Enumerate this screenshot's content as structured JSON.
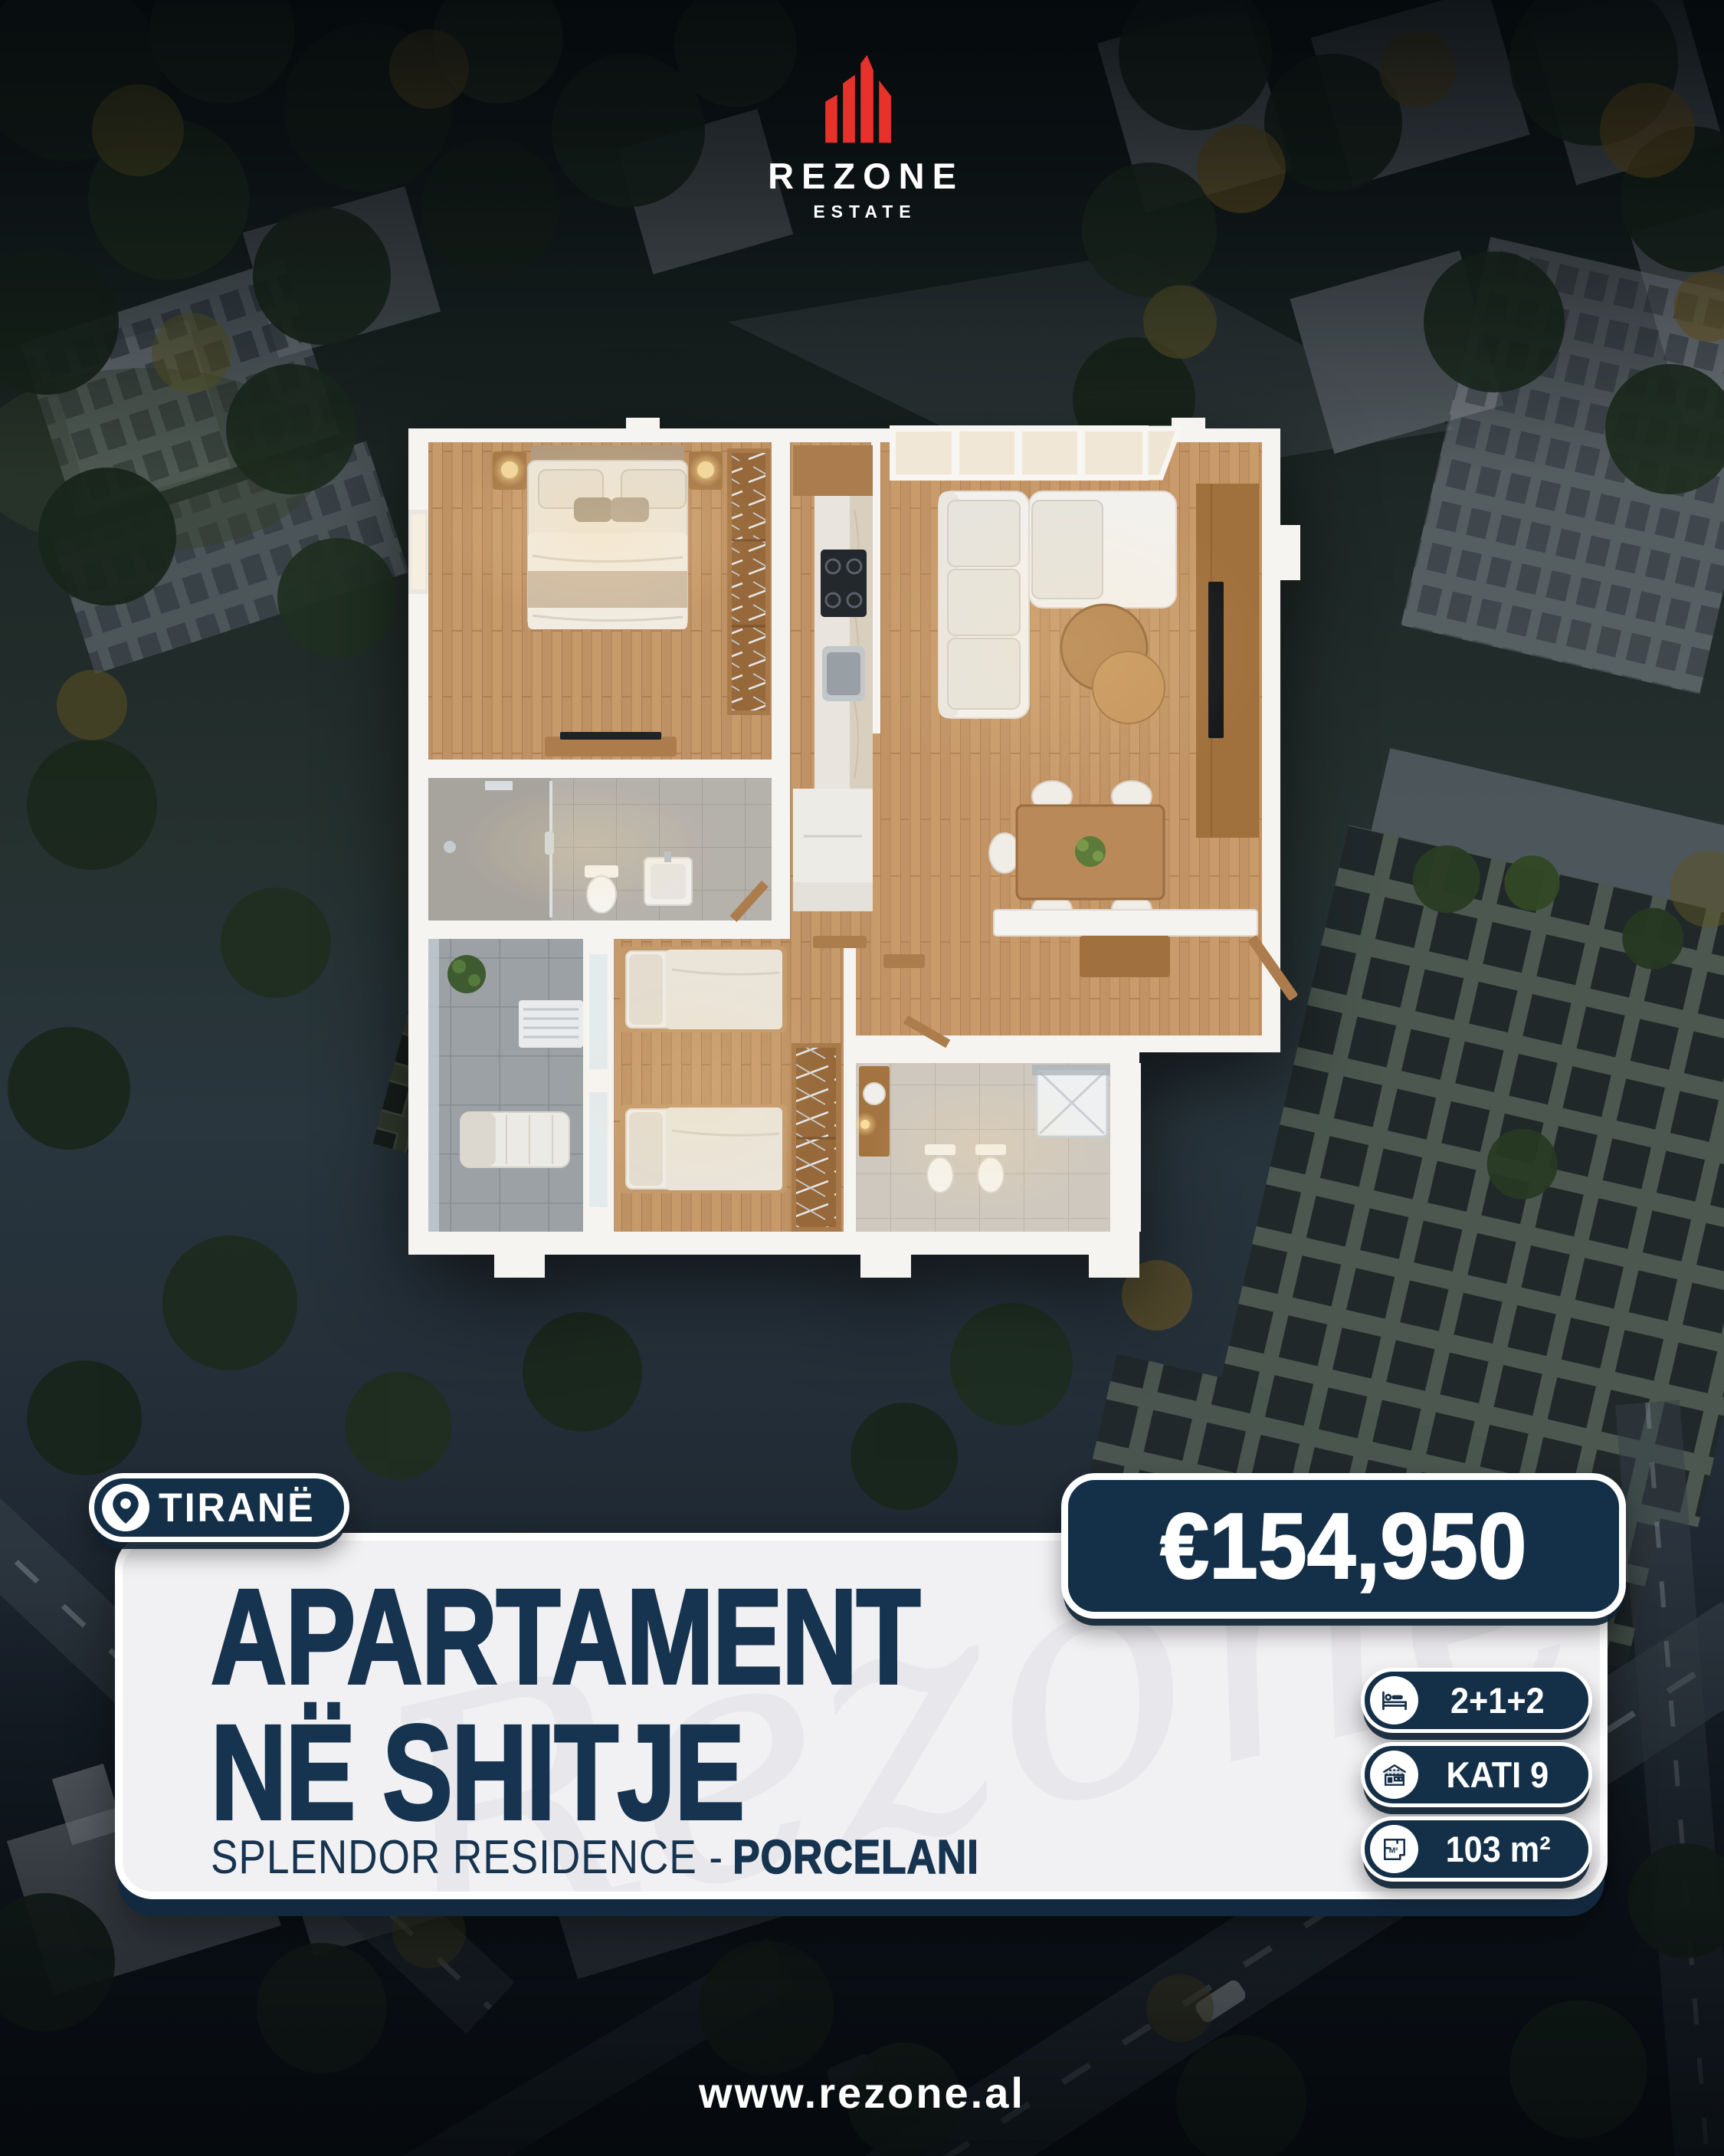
{
  "brand": {
    "name": "REZONE",
    "tagline": "ESTATE"
  },
  "location_badge": {
    "label": "TIRANË"
  },
  "price_badge": {
    "amount": "€154,950"
  },
  "listing": {
    "title_line1": "APARTAMENT",
    "title_line2": "NË SHITJE",
    "subtitle_prefix": "SPLENDOR RESIDENCE -",
    "subtitle_emphasis": "PORCELANI"
  },
  "specs": [
    {
      "icon": "bed-icon",
      "label": "2+1+2"
    },
    {
      "icon": "building-floors-icon",
      "label": "KATI 9"
    },
    {
      "icon": "floor-area-icon",
      "label": "103 m²"
    }
  ],
  "footer": {
    "website": "www.rezone.al"
  },
  "watermark": {
    "text": "Rezone"
  },
  "colors": {
    "navy": "#143049",
    "card_bg": "#f1f0f3",
    "brand_red": "#e8312b",
    "text_navy": "#16334f"
  }
}
